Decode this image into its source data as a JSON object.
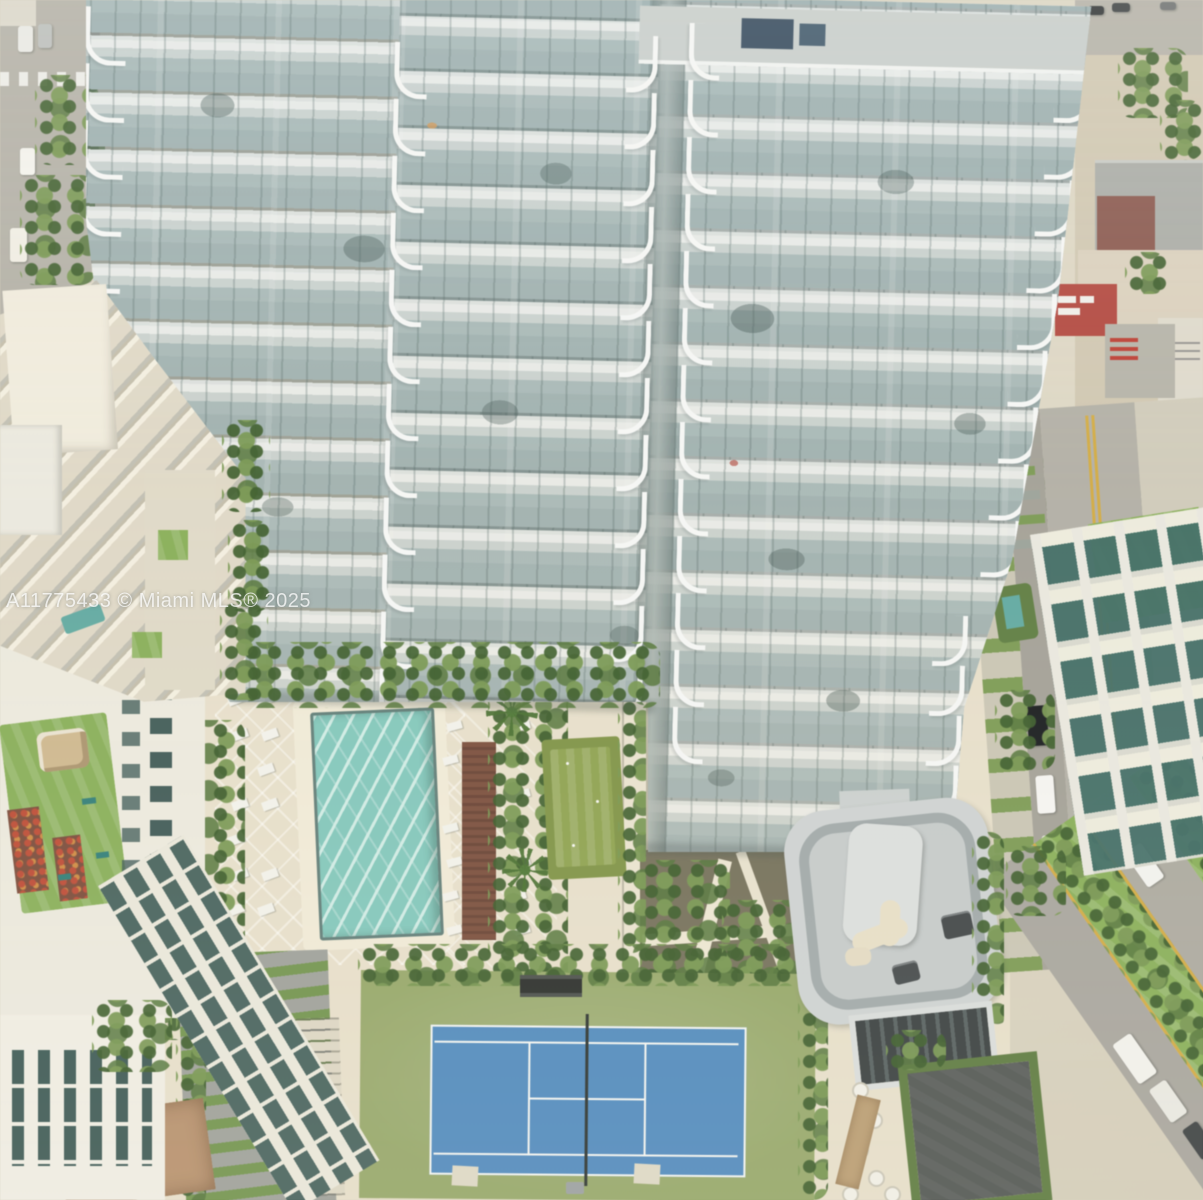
{
  "watermark": "A11775433 © Miami MLS® 2025",
  "palette": {
    "pool_water": "#7fc6ba",
    "water_shimmer": "#cdeae2",
    "deck": "#e6ddc7",
    "tennis_blue": "#4e8abf",
    "tennis_green": "#95a766",
    "putting_green": "#7e9342",
    "tree_green": "#6b8f49",
    "lawn_green": "#86ae54",
    "street_gray": "#b2aea4",
    "facade_glass": "#a2b6b6",
    "balcony_white": "#eef1ee",
    "roof_red": "#b5453c"
  }
}
